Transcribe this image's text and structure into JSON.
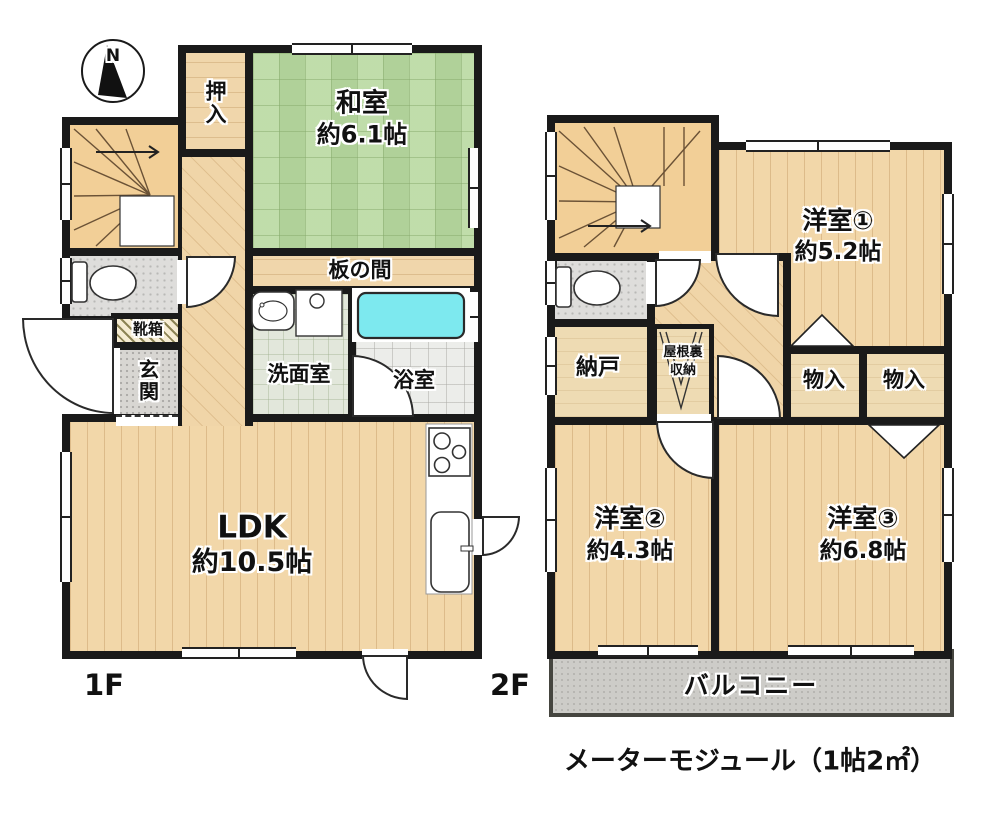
{
  "compass": {
    "north": "N"
  },
  "floor1": {
    "label": "1F",
    "rooms": {
      "oshiire": {
        "name": "押入"
      },
      "washitsu": {
        "name": "和室",
        "size": "約6.1帖"
      },
      "itanoma": {
        "name": "板の間"
      },
      "senmen": {
        "name": "洗面室"
      },
      "yokushitsu": {
        "name": "浴室"
      },
      "kutsubako": {
        "name": "靴箱"
      },
      "genkan": {
        "name": "玄関"
      },
      "ldk": {
        "name": "LDK",
        "size": "約10.5帖"
      }
    }
  },
  "floor2": {
    "label": "2F",
    "rooms": {
      "yoshitsu1": {
        "name": "洋室①",
        "size": "約5.2帖"
      },
      "nando": {
        "name": "納戸"
      },
      "yaneura": {
        "line1": "屋根裏",
        "line2": "収納"
      },
      "monoire1": {
        "name": "物入"
      },
      "monoire2": {
        "name": "物入"
      },
      "yoshitsu2": {
        "name": "洋室②",
        "size": "約4.3帖"
      },
      "yoshitsu3": {
        "name": "洋室③",
        "size": "約6.8帖"
      },
      "balcony": {
        "name": "バルコニー"
      }
    }
  },
  "footer": {
    "note": "メーターモジュール（1帖2㎡）"
  },
  "colors": {
    "wall": "#1a1a1a",
    "tatami": "#b9d9a1",
    "wood": "#f2d7a9",
    "tub": "#7de9ef",
    "balcony": "#cdccc8"
  }
}
